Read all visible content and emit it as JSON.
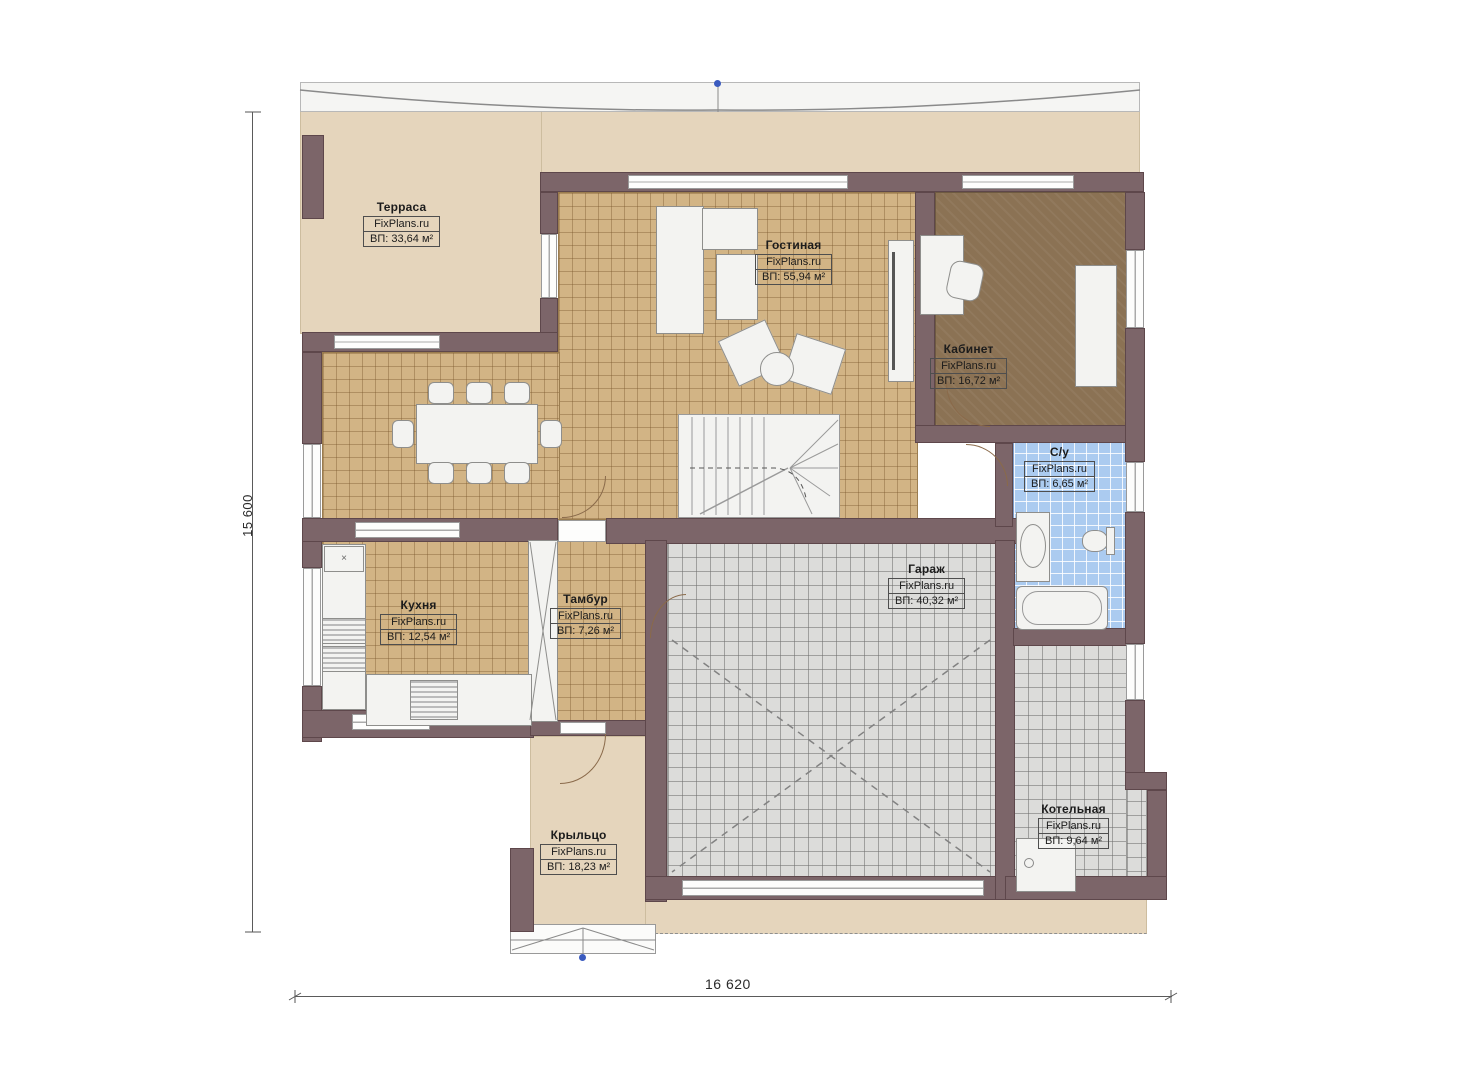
{
  "brand": "FixPlans.ru",
  "rooms": [
    {
      "name": "Терраса",
      "site": "FixPlans.ru",
      "area": "ВП: 33,64 м²"
    },
    {
      "name": "Гостиная",
      "site": "FixPlans.ru",
      "area": "ВП: 55,94 м²"
    },
    {
      "name": "Кабинет",
      "site": "FixPlans.ru",
      "area": "ВП: 16,72 м²"
    },
    {
      "name": "С/у",
      "site": "FixPlans.ru",
      "area": "ВП: 6,65 м²"
    },
    {
      "name": "Кухня",
      "site": "FixPlans.ru",
      "area": "ВП: 12,54 м²"
    },
    {
      "name": "Тамбур",
      "site": "FixPlans.ru",
      "area": "ВП: 7,26 м²"
    },
    {
      "name": "Гараж",
      "site": "FixPlans.ru",
      "area": "ВП: 40,32 м²"
    },
    {
      "name": "Котельная",
      "site": "FixPlans.ru",
      "area": "ВП: 9,64 м²"
    },
    {
      "name": "Крыльцо",
      "site": "FixPlans.ru",
      "area": "ВП: 18,23 м²"
    }
  ],
  "dimensions": {
    "bottom": "16 620",
    "left": "15 600"
  },
  "colors": {
    "wall": "#7c6569",
    "terrace": "#e5d5bc",
    "tile_tan": "#d2b485",
    "tile_gray": "#dcdcda",
    "tile_blue": "#abcbf0",
    "office_floor": "#8b7254",
    "marker_blue": "#3b5bbf"
  }
}
